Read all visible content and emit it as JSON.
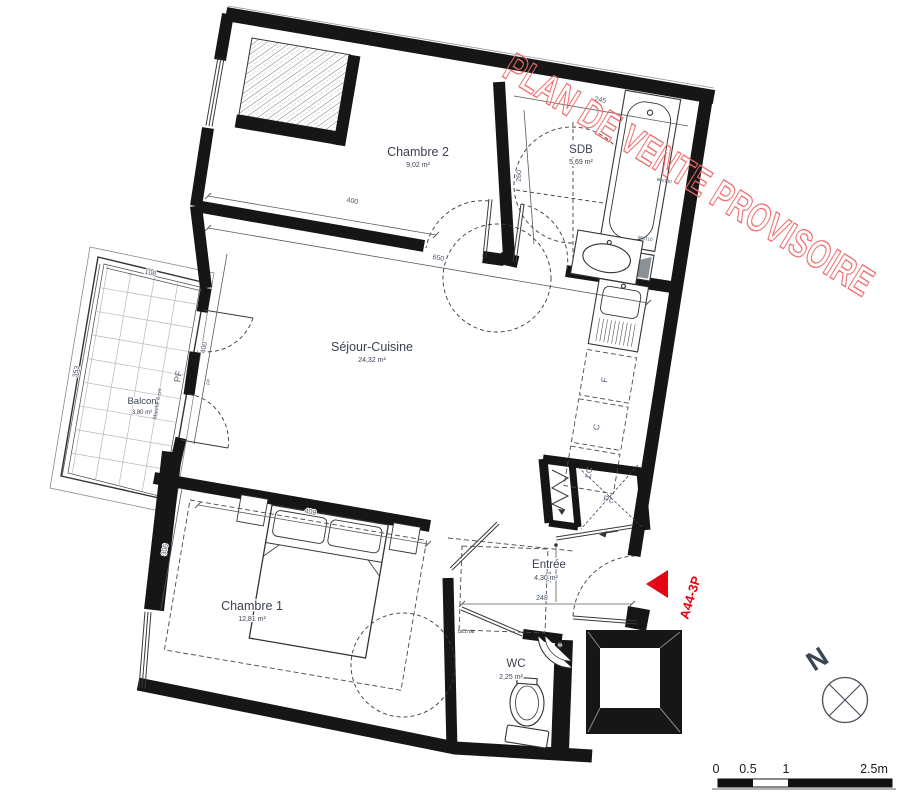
{
  "watermark": {
    "text": "PLAN DE VENTE PROVISOIRE",
    "color": "#ef6a6a"
  },
  "unit": {
    "ref": "A44-3P",
    "color": "#e30613"
  },
  "rooms": {
    "chambre2": {
      "name": "Chambre 2",
      "area": "9,02 m²"
    },
    "sdb": {
      "name": "SDB",
      "area": "5,69 m²"
    },
    "sejour": {
      "name": "Séjour-Cuisine",
      "area": "24,32 m²"
    },
    "balcon": {
      "name": "Balcon",
      "area": "3,80 m²"
    },
    "chambre1": {
      "name": "Chambre 1",
      "area": "12,81 m²"
    },
    "entree": {
      "name": "Entrée",
      "area": "4,30 m²"
    },
    "wc": {
      "name": "WC",
      "area": "2,25 m²"
    }
  },
  "dims": {
    "chambre2_w": "400",
    "sejour_w": "650",
    "sdb_w": "245",
    "sdb_h": "260",
    "balcon_w": "108",
    "balcon_d": "353",
    "sejour_h": "400",
    "chambre1_h": "306",
    "chambre1_w": "409",
    "entree_w": "248",
    "entree_h": "161",
    "fixture_a": "80x130",
    "fixture_b": "80x110"
  },
  "labels": {
    "pf": "PF",
    "pf_small": "PF",
    "marche": "Marche 6 cm",
    "kitchen_f": "F",
    "kitchen_c": "C",
    "kitchen_lc": "LC",
    "closet_pl": "PL",
    "door_ref": "DE170B"
  },
  "compass": {
    "label": "N"
  },
  "scalebar": {
    "t0": "0",
    "t1": "0.5",
    "t2": "1",
    "t3": "2.5m"
  },
  "colors": {
    "wall": "#161616",
    "dim_text": "#47566b",
    "label_text": "#3b4252"
  }
}
